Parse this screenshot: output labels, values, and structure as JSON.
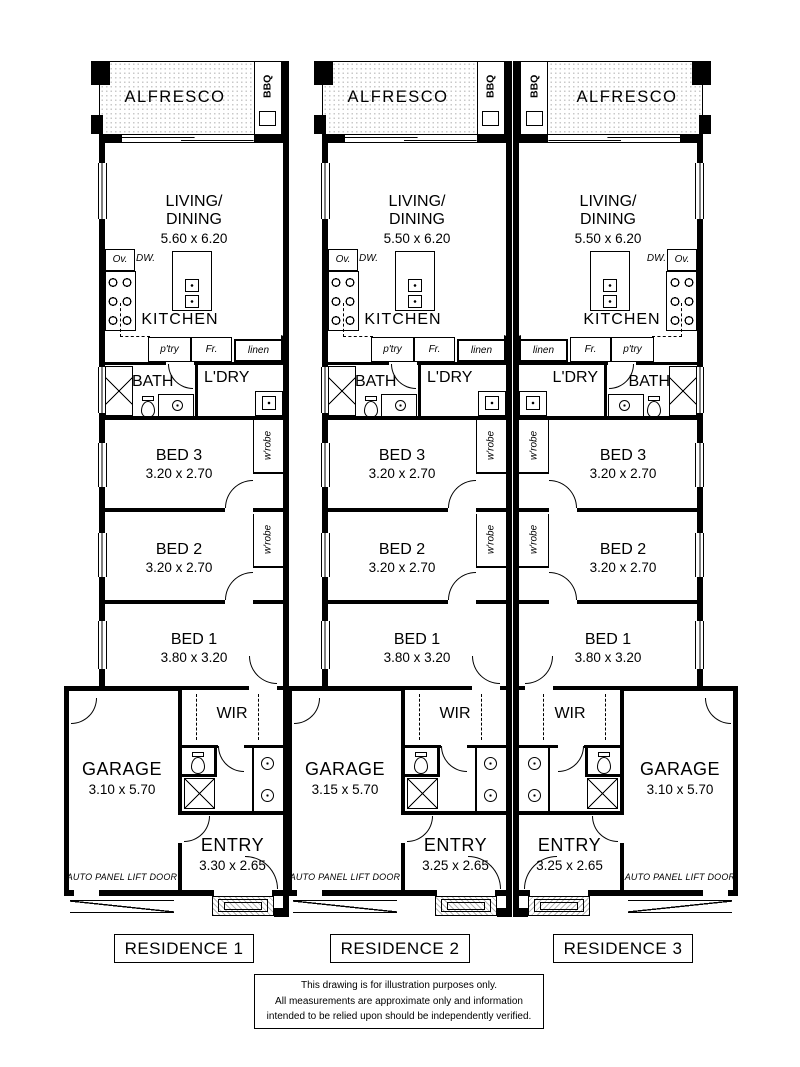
{
  "labels": {
    "alfresco": "ALFRESCO",
    "bbq": "BBQ",
    "living_line1": "LIVING/",
    "living_line2": "DINING",
    "oven": "Ov.",
    "dishwasher": "DW.",
    "kitchen": "KITCHEN",
    "pantry": "p'try",
    "fridge": "Fr.",
    "linen": "linen",
    "bath": "BATH",
    "laundry": "L'DRY",
    "wrobe": "w'robe",
    "bed3": "BED 3",
    "bed2": "BED 2",
    "bed1": "BED 1",
    "wir": "WIR",
    "garage": "GARAGE",
    "entry": "ENTRY",
    "garage_door": "AUTO PANEL LIFT DOOR"
  },
  "units": [
    {
      "name": "RESIDENCE 1",
      "living_dim": "5.60 x 6.20",
      "bed3_dim": "3.20 x 2.70",
      "bed2_dim": "3.20 x 2.70",
      "bed1_dim": "3.80 x 3.20",
      "garage_dim": "3.10 x 5.70",
      "entry_dim": "3.30 x 2.65"
    },
    {
      "name": "RESIDENCE 2",
      "living_dim": "5.50 x 6.20",
      "bed3_dim": "3.20 x 2.70",
      "bed2_dim": "3.20 x 2.70",
      "bed1_dim": "3.80 x 3.20",
      "garage_dim": "3.15 x 5.70",
      "entry_dim": "3.25 x 2.65"
    },
    {
      "name": "RESIDENCE 3",
      "living_dim": "5.50 x 6.20",
      "bed3_dim": "3.20 x 2.70",
      "bed2_dim": "3.20 x 2.70",
      "bed1_dim": "3.80 x 3.20",
      "garage_dim": "3.10 x 5.70",
      "entry_dim": "3.25 x 2.65"
    }
  ],
  "disclaimer": {
    "line1": "This drawing is for illustration purposes only.",
    "line2": "All measurements are approximate only and information",
    "line3": "intended to be relied upon should be independently verified."
  },
  "colors": {
    "ink": "#000000",
    "paper": "#ffffff",
    "hatch_gray": "#c9c9c9"
  }
}
